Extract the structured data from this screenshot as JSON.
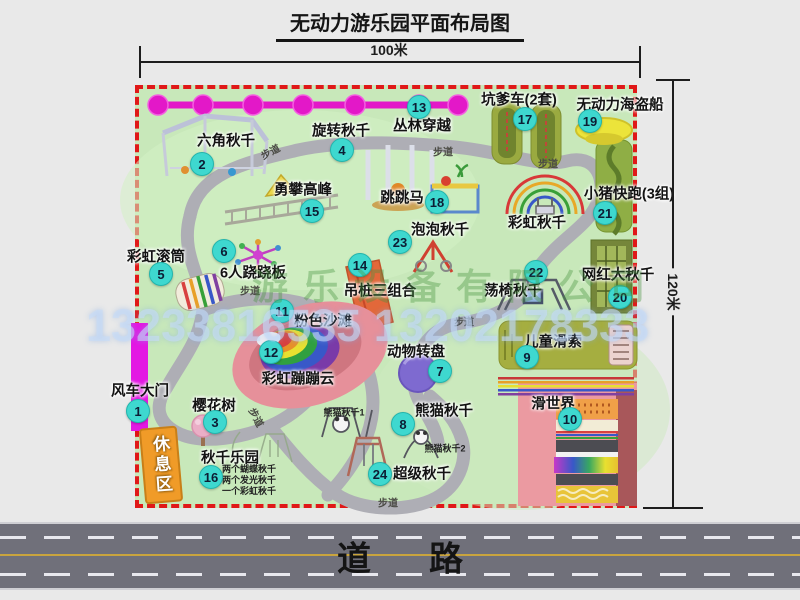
{
  "title": "无动力游乐园平面布局图",
  "dimensions": {
    "top": "100米",
    "right": "120米"
  },
  "road_label": "道路",
  "rest_area_label": "休息区",
  "path_label": "步道",
  "watermark": {
    "company": "游乐设备有限公司",
    "phone": "13233816535 13202178333"
  },
  "attractions": [
    {
      "num": "1",
      "label": "风车大门"
    },
    {
      "num": "2",
      "label": "六角秋千"
    },
    {
      "num": "3",
      "label": "樱花树"
    },
    {
      "num": "4",
      "label": "旋转秋千"
    },
    {
      "num": "5",
      "label": "彩虹滚筒"
    },
    {
      "num": "6",
      "label": "6人跷跷板"
    },
    {
      "num": "7",
      "label": "动物转盘"
    },
    {
      "num": "8",
      "label": "熊猫秋千"
    },
    {
      "num": "9",
      "label": "儿童滑索"
    },
    {
      "num": "10",
      "label": "滑世界"
    },
    {
      "num": "11",
      "label": "粉色沙滩"
    },
    {
      "num": "12",
      "label": "彩虹蹦蹦云"
    },
    {
      "num": "13",
      "label": "丛林穿越"
    },
    {
      "num": "14",
      "label": "吊桩三组合"
    },
    {
      "num": "15",
      "label": "勇攀高峰"
    },
    {
      "num": "16",
      "label": "秋千乐园"
    },
    {
      "num": "17",
      "label": "坑爹车(2套)"
    },
    {
      "num": "18",
      "label": "跳跳马"
    },
    {
      "num": "19",
      "label": "无动力海盗船"
    },
    {
      "num": "20",
      "label": "网红大秋千"
    },
    {
      "num": "21",
      "label": "小猪快跑(3组)"
    },
    {
      "num": "22",
      "label": "荡椅秋千"
    },
    {
      "num": "23",
      "label": "泡泡秋千"
    },
    {
      "num": "24",
      "label": "超级秋千"
    }
  ],
  "extra_labels": {
    "rainbow_swing": "彩虹秋千",
    "panda_swing_1": "熊猫秋千1",
    "panda_swing_2": "熊猫秋千2"
  },
  "swing_park_notes": [
    "两个蝴蝶秋千",
    "两个发光秋千",
    "一个彩虹秋千"
  ],
  "colors": {
    "border_red": "#e01818",
    "park_green": "#c8e8ba",
    "badge_cyan": "#3ed8cf",
    "gate_magenta": "#e318e3",
    "chain_magenta": "#e318c8",
    "road_gray": "#70707a"
  }
}
